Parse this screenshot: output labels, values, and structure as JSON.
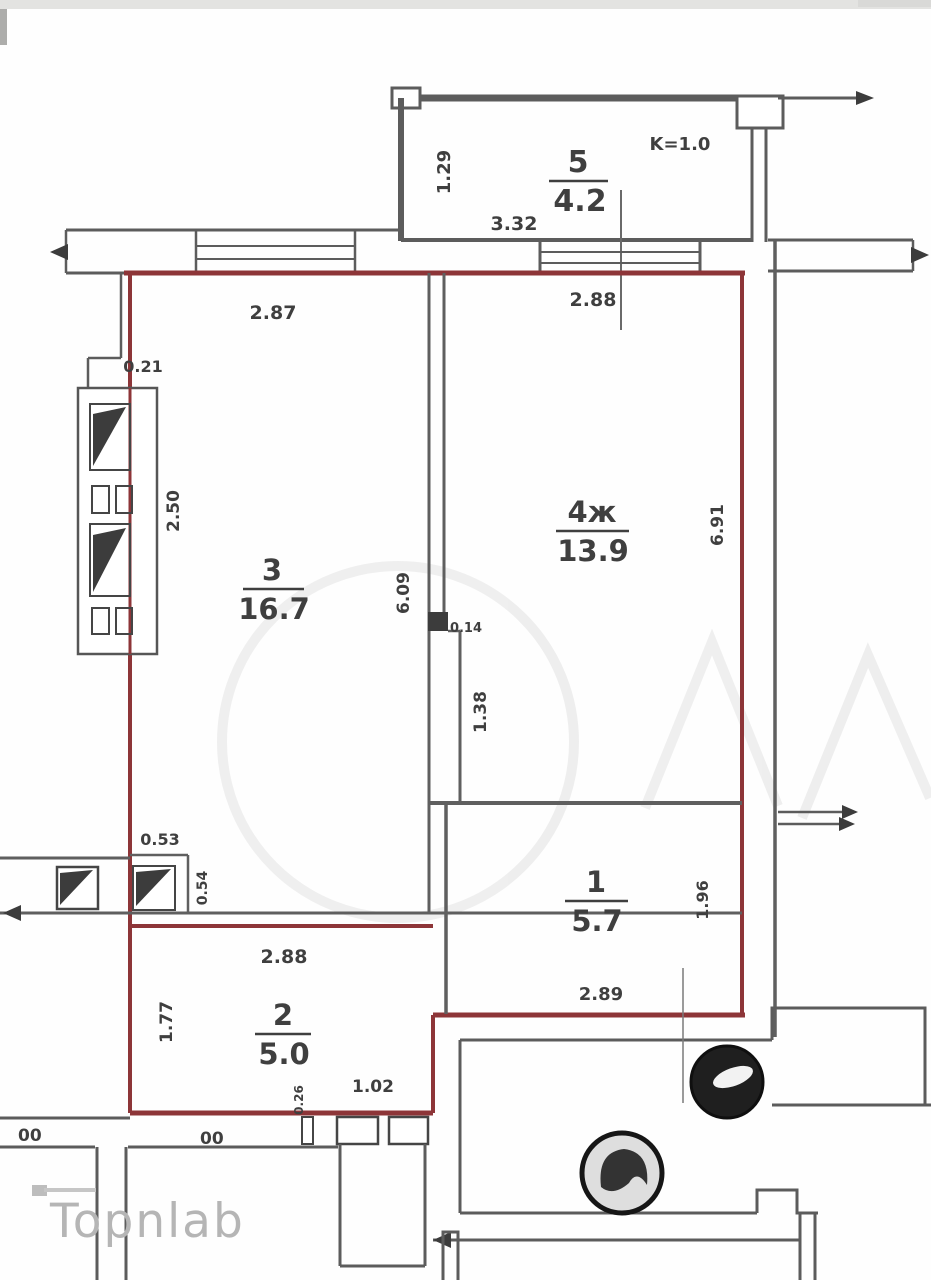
{
  "watermark": {
    "brand": "Topnlab"
  },
  "plan": {
    "coefficient": "K=1.0",
    "rooms": {
      "r5": {
        "number": "5",
        "area": "4.2"
      },
      "r3": {
        "number": "3",
        "area": "16.7"
      },
      "r4": {
        "number": "4ж",
        "area": "13.9"
      },
      "r1": {
        "number": "1",
        "area": "5.7"
      },
      "r2": {
        "number": "2",
        "area": "5.0"
      }
    },
    "dims": {
      "balcony_depth": "1.29",
      "balcony_width": "3.32",
      "room3_top": "2.87",
      "room4_top": "2.88",
      "left_step": "0.21",
      "window_span": "2.50",
      "room3_side": "6.09",
      "wall_jog": "0.14",
      "niche": "1.38",
      "room4_side": "6.91",
      "hall_top": "0.53",
      "hall_side": "0.54",
      "room2_top": "2.88",
      "room2_side": "1.77",
      "door": "1.02",
      "door_step": "0.26",
      "room1_bottom": "2.89",
      "room1_side": "1.96",
      "duct_left": "00",
      "duct_right": "00"
    },
    "colors": {
      "boundary": "#8d3538",
      "wall": "#5f5f5f",
      "label": "#3f3f3f",
      "watermark": "#b5b5b5"
    }
  }
}
